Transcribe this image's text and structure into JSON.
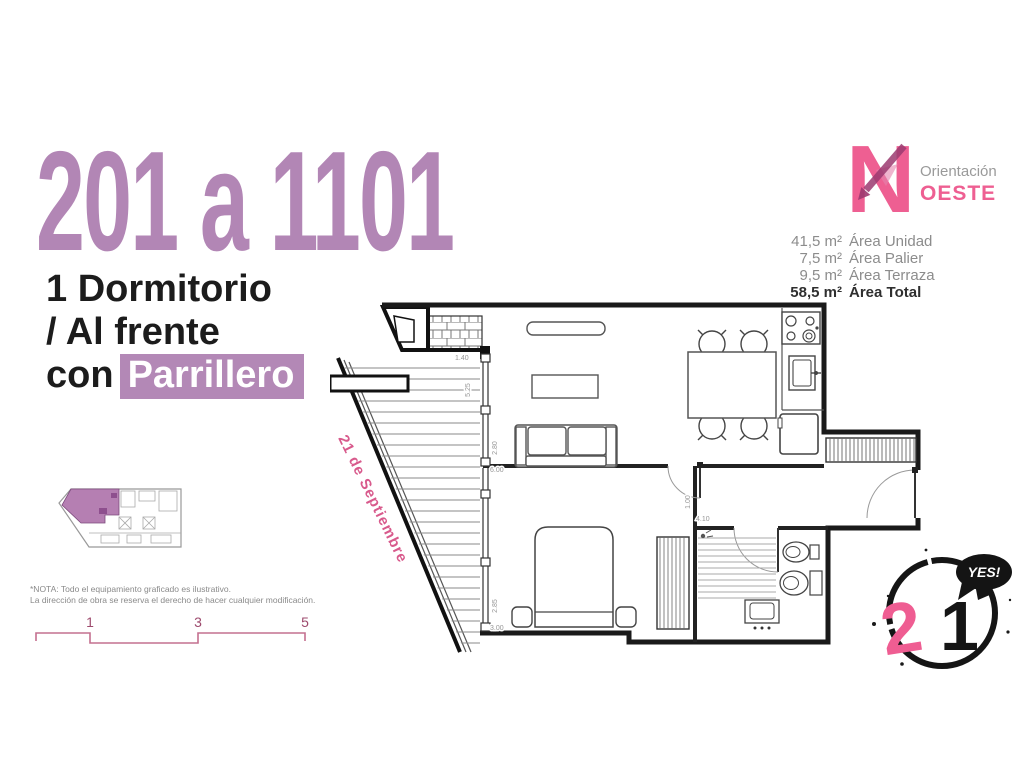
{
  "header": {
    "title": "201 a 1101",
    "subtitle_line1": "1 Dormitorio",
    "subtitle_line2": "/ Al frente",
    "subtitle_line3_prefix": "con",
    "subtitle_highlight": "Parrillero"
  },
  "orientation": {
    "compass_letter": "N",
    "label": "Orientación",
    "value": "OESTE"
  },
  "areas": {
    "rows": [
      {
        "value": "41,5 m²",
        "label": "Área Unidad"
      },
      {
        "value": "7,5 m²",
        "label": "Área Palier"
      },
      {
        "value": "9,5 m²",
        "label": "Área Terraza"
      }
    ],
    "total": {
      "value": "58,5 m²",
      "label": "Área Total"
    }
  },
  "plan": {
    "street_label": "21 de Septiembre",
    "dims": {
      "terrace": [
        "1.40",
        "5.25"
      ],
      "living": [
        "2.80",
        "6.00"
      ],
      "bedroom": [
        "2.85",
        "3.00"
      ],
      "entry": [
        "1.00",
        "4.10"
      ]
    }
  },
  "note": {
    "line1": "*NOTA: Todo el equipamiento graficado es ilustrativo.",
    "line2": "La dirección de obra se reserva el derecho de hacer cualquier modificación."
  },
  "scale_bar": {
    "labels": [
      "1",
      "3",
      "5"
    ]
  },
  "logo": {
    "number_pink": "2",
    "number_black": "1",
    "bubble": "YES!"
  },
  "colors": {
    "title_purple": "#b286b5",
    "highlight_purple": "#b388b6",
    "pink": "#ee5f92",
    "arrow_dark_pink": "#9c3a70",
    "street_pink": "#d85a8c",
    "scale_pink": "#c4708f",
    "gray_text": "#8c8c8c",
    "wall_black": "#1a1a1a"
  }
}
